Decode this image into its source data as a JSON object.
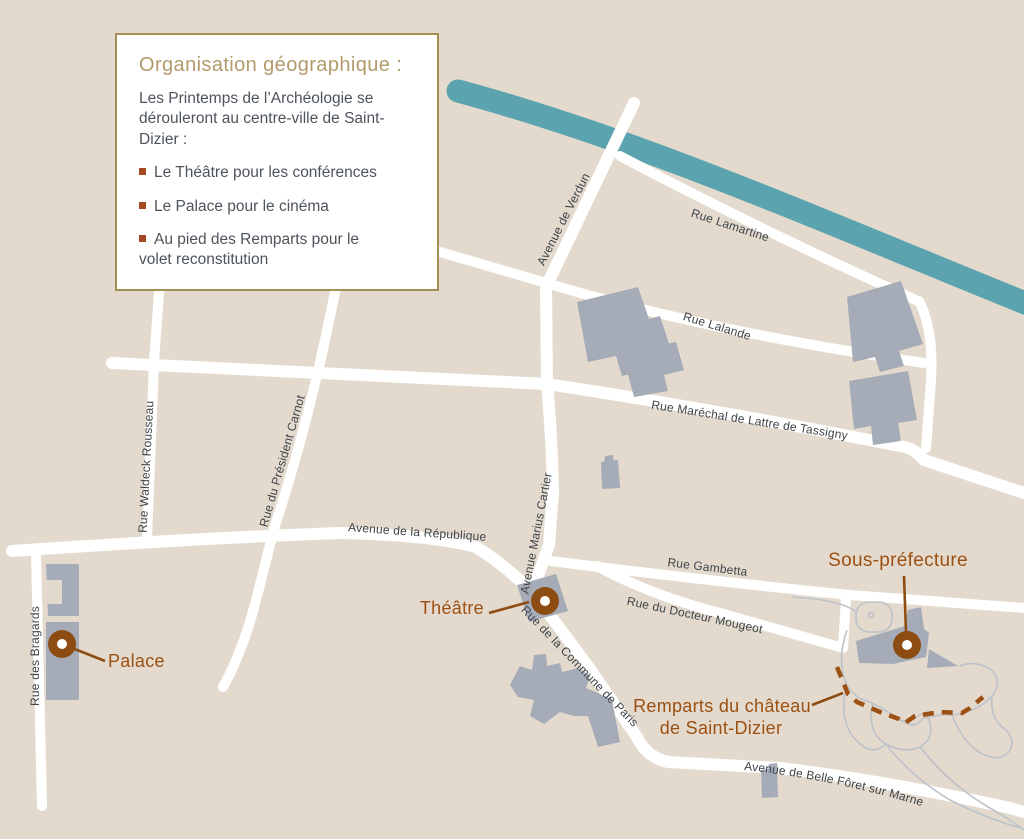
{
  "legend": {
    "title": "Organisation géographique :",
    "intro": "Les Printemps de l’Archéologie se dérouleront au centre-ville de Saint-Dizier :",
    "bullets": [
      "Le Théâtre pour les conférences",
      "Le Palace pour le cinéma",
      "Au pied des Remparts pour le volet reconstitution"
    ]
  },
  "map": {
    "street_labels": [
      {
        "id": "avenue-de-verdun",
        "text": "Avenue de Verdun"
      },
      {
        "id": "rue-lamartine",
        "text": "Rue Lamartine"
      },
      {
        "id": "rue-lalande",
        "text": "Rue Lalande"
      },
      {
        "id": "rue-marechal",
        "text": "Rue Maréchal de Lattre de Tassigny"
      },
      {
        "id": "rue-waldeck-rousseau",
        "text": "Rue Waldeck Rousseau"
      },
      {
        "id": "rue-president-carnot",
        "text": "Rue du Président Carnot"
      },
      {
        "id": "avenue-republique",
        "text": "Avenue de la République"
      },
      {
        "id": "avenue-marius-cartier",
        "text": "Avenue Marius Cartier"
      },
      {
        "id": "rue-gambetta",
        "text": "Rue Gambetta"
      },
      {
        "id": "rue-docteur-mougeot",
        "text": "Rue du Docteur Mougeot"
      },
      {
        "id": "rue-commune-de-paris",
        "text": "Rue de la Commune de Paris"
      },
      {
        "id": "rue-des-bragards",
        "text": "Rue des Bragards"
      },
      {
        "id": "avenue-belle-foret",
        "text": "Avenue de Belle Fôret sur Marne"
      }
    ],
    "poi": {
      "theatre": "Théâtre",
      "palace": "Palace",
      "sous_prefecture": "Sous-préfecture",
      "remparts_line1": "Remparts du château",
      "remparts_line2": "de Saint-Dizier"
    },
    "icons": {
      "poi_marker": "donut-circle-marker",
      "bullet": "small-square"
    }
  },
  "theme": {
    "background": "#e3dacd",
    "street": "#ffffff",
    "river": "#5ba3af",
    "building": "#a5abb7",
    "outline": "#bcc2c9",
    "rust": "#9c5012",
    "marker": "#8d4c12",
    "legend_title": "#b39a6b",
    "legend_border": "#a28f55",
    "text_dark": "#4e545c",
    "bullet": "#a34a22",
    "street_text": "#3f444a"
  }
}
